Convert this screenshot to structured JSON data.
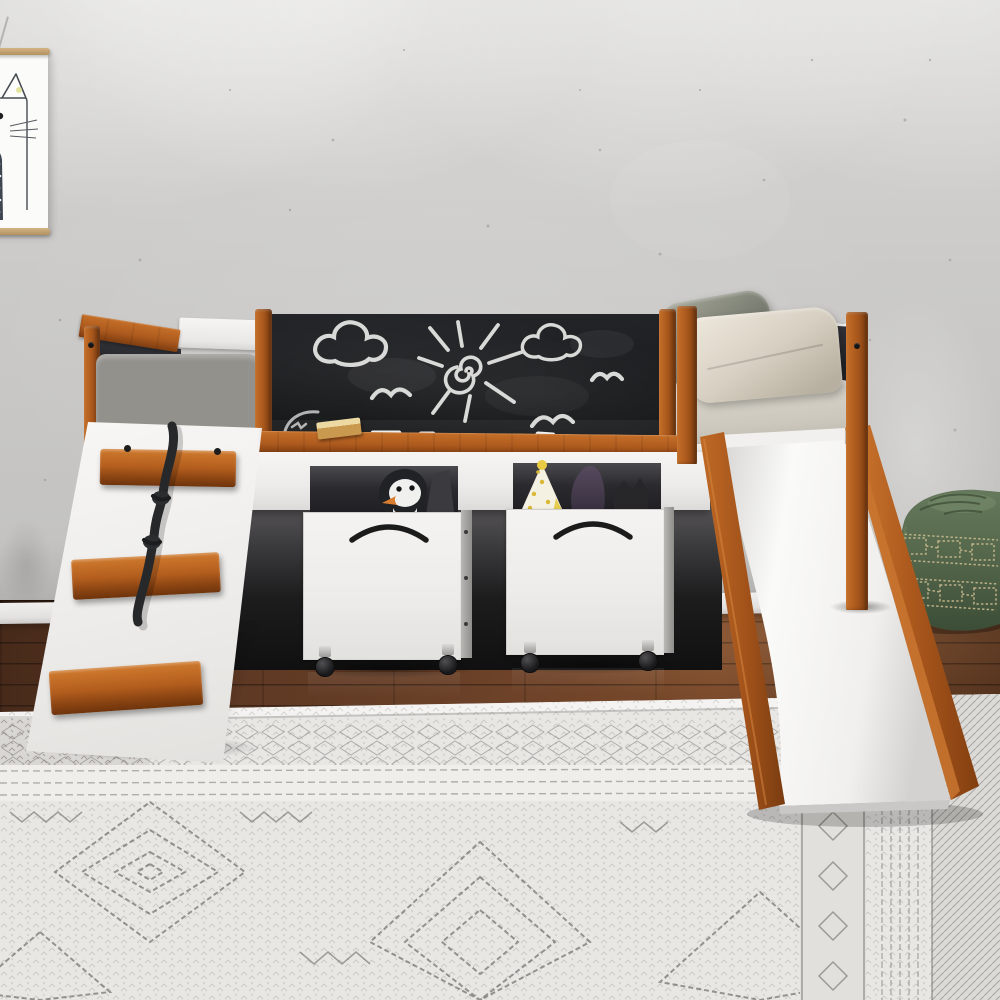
{
  "meta": {
    "title": "Kids low loft bed with slide, climbing ramp and chalkboard — product photo",
    "canvas": {
      "width": 1000,
      "height": 1000
    }
  },
  "scene": {
    "setting": {
      "wall": "light gray concrete wall with four soft ceiling spotlight cones",
      "baseboard": "white baseboard",
      "floor": "dark walnut plank wood floor",
      "rug": "white and gray boho pattern rug with diamond medallions and border bands"
    },
    "objects": {
      "poster": {
        "subject": "minimalist cat illustration with wood hangers",
        "position": "top-left, partially cropped"
      },
      "loft_bed": {
        "style": "low loft bed, cherry wood posts and rails with white boards",
        "chalkboard": {
          "drawings": [
            "cloud",
            "sun with spiral center and rays",
            "cloud",
            "three seagull scribbles"
          ],
          "accessories": [
            "tan chalk eraser",
            "white chalk sticks"
          ]
        },
        "left_end": {
          "headboard": "black inset panel",
          "bedding": "gray rumpled blanket"
        },
        "right_end": {
          "footboard": "black inset panel",
          "pillows": [
            "sage green pillow",
            "cream pillow"
          ],
          "mattress": "cream fitted sheet"
        }
      },
      "climbing_ramp": {
        "steps": 3,
        "step_material": "cherry wood",
        "rope": "black knotted climbing rope",
        "screw_caps": 2
      },
      "slide": {
        "surface": "white",
        "rails": "cherry wood",
        "direction": "from footboard down to bottom-right onto rug"
      },
      "storage_bins": [
        {
          "color": "white",
          "handle": "black bow handle",
          "wheels": "black casters",
          "toys": [
            "black & white penguin plush with orange beak",
            "dark gray fabric"
          ]
        },
        {
          "color": "white",
          "handle": "black bow handle",
          "wheels": "black casters",
          "toys": [
            "white cone with gold polka dots",
            "purple plush",
            "black cat-ear plush"
          ]
        }
      ],
      "pouf": {
        "color": "green leather",
        "detail": "tufted top, beige greek-key stitch bands",
        "position": "right edge, partially cropped, behind slide rail"
      }
    }
  },
  "palette": {
    "wall": "#cbcac8",
    "wall_light": "#d7d6d4",
    "wood": "#ad5a1e",
    "wood_light": "#c56f28",
    "wood_dark": "#7e3d10",
    "frame_white": "#f3f2f0",
    "chalkboard": "#1d1e20",
    "chalk": "#e9e9e7",
    "panel_black": "#222327",
    "mattress_gray": "#93918c",
    "mattress_cream": "#d3cfc5",
    "pillow_sage": "#7e8176",
    "pillow_cream": "#d9d3c6",
    "rope": "#27282a",
    "bin_white": "#f0efec",
    "floor": "#5c3824",
    "rug": "#e8e7e4",
    "rug_ink": "#5f5d59",
    "pouf_green": "#55684c",
    "stitch": "#c9ba8e",
    "beak_orange": "#d97e2e"
  }
}
